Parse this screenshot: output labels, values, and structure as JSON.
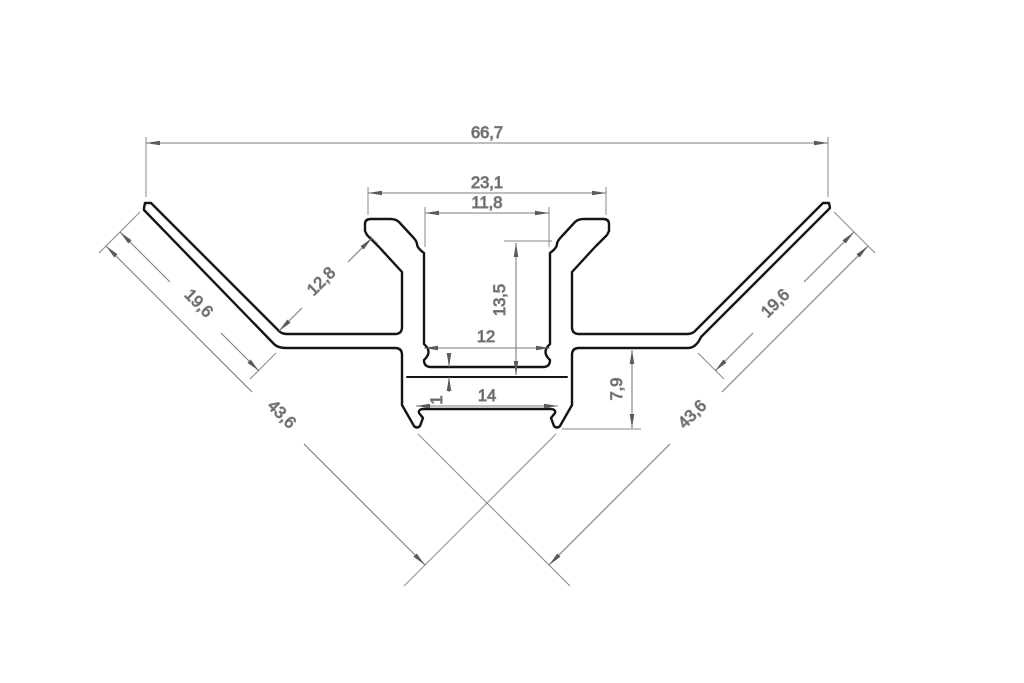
{
  "drawing": {
    "kind": "technical cross-section drawing",
    "object": "45-degree corner aluminium LED profile extrusion"
  },
  "colors": {
    "background": "#ffffff",
    "outline": "#141414",
    "dimension": "#7e7e7e",
    "arrow": "#5a5a5a",
    "text": "#4d4d4d"
  },
  "dims": {
    "overall_width": "66,7",
    "hook_span": "23,1",
    "opening_width": "11,8",
    "hook_reach": "12,8",
    "wing_left": "19,6",
    "wing_right": "19,6",
    "cavity_depth": "13,5",
    "cavity_width": "12",
    "floor_thickness": "1",
    "base_width": "14",
    "base_drop": "7,9",
    "diagonal_left": "43,6",
    "diagonal_right": "43,6"
  }
}
